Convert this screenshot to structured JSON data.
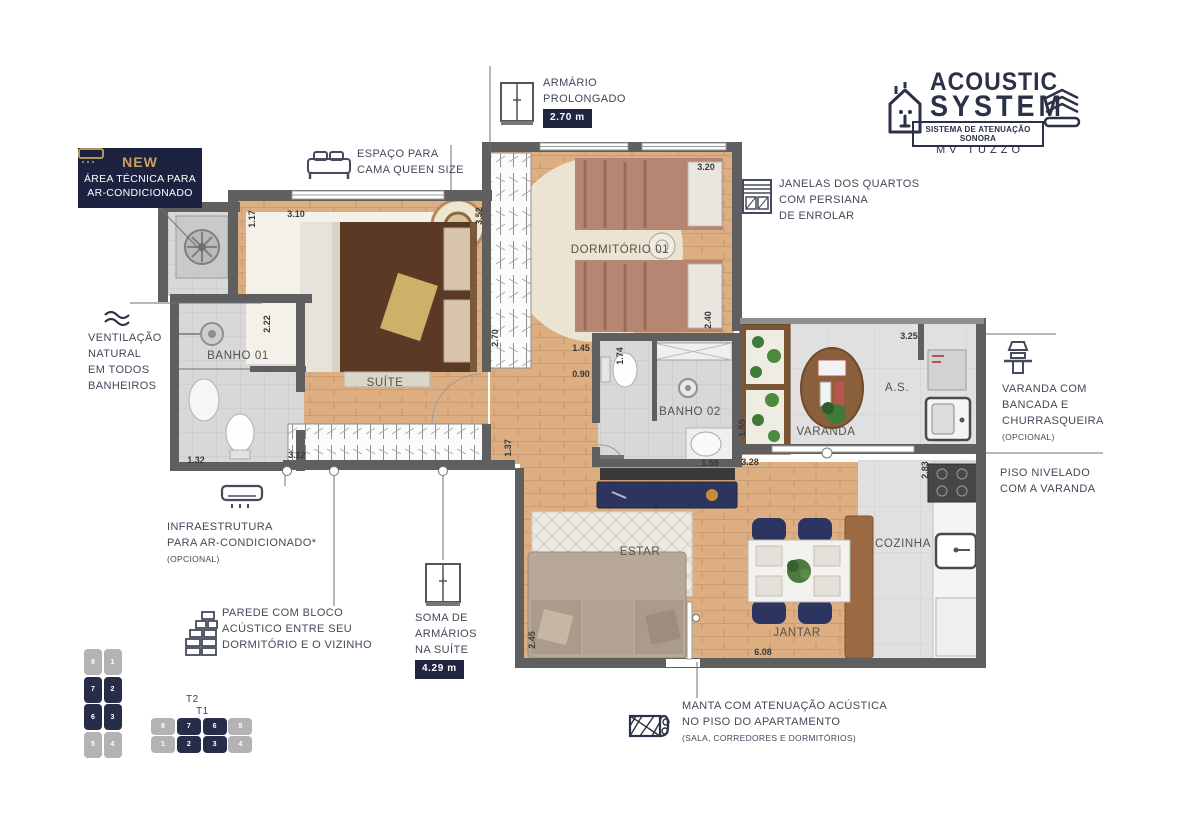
{
  "logo": {
    "title_line1": "ACOUSTIC",
    "title_line2": "SYSTEM",
    "subtitle": "SISTEMA DE ATENUAÇÃO SONORA",
    "brand": "MV TUZZO"
  },
  "badges": {
    "new_tag": "NEW",
    "area_tecnica": [
      "ÁREA TÉCNICA PARA",
      "AR-CONDICIONADO"
    ],
    "armario_prolongado": {
      "lines": [
        "ARMÁRIO",
        "PROLONGADO"
      ],
      "value": "2.70 m"
    },
    "soma_armarios": {
      "lines": [
        "SOMA DE",
        "ARMÁRIOS",
        "NA SUÍTE"
      ],
      "value": "4.29 m"
    }
  },
  "annotations": {
    "espaco_cama": [
      "ESPAÇO PARA",
      "CAMA QUEEN SIZE"
    ],
    "janelas": [
      "JANELAS DOS QUARTOS",
      "COM PERSIANA",
      "DE ENROLAR"
    ],
    "ventilacao": [
      "VENTILAÇÃO",
      "NATURAL",
      "EM TODOS",
      "BANHEIROS"
    ],
    "varanda_churrasqueira": [
      "VARANDA COM",
      "BANCADA E",
      "CHURRASQUEIRA"
    ],
    "varanda_churrasqueira_note": "(OPCIONAL)",
    "piso_nivelado": [
      "PISO NIVELADO",
      "COM A VARANDA"
    ],
    "infraestrutura": [
      "INFRAESTRUTURA",
      "PARA AR-CONDICIONADO*"
    ],
    "infraestrutura_note": "(OPCIONAL)",
    "parede_acustica": [
      "PAREDE COM BLOCO",
      "ACÚSTICO ENTRE SEU",
      "DORMITÓRIO E O VIZINHO"
    ],
    "manta": [
      "MANTA COM ATENUAÇÃO ACÚSTICA",
      "NO PISO DO APARTAMENTO"
    ],
    "manta_note": "(SALA, CORREDORES E DORMITÓRIOS)"
  },
  "plan": {
    "rooms": [
      {
        "label": "SUÍTE",
        "x": 385,
        "y": 383
      },
      {
        "label": "BANHO 01",
        "x": 238,
        "y": 356
      },
      {
        "label": "DORMITÓRIO 01",
        "x": 620,
        "y": 250
      },
      {
        "label": "BANHO 02",
        "x": 690,
        "y": 412
      },
      {
        "label": "VARANDA",
        "x": 826,
        "y": 432
      },
      {
        "label": "A.S.",
        "x": 897,
        "y": 388
      },
      {
        "label": "COZINHA",
        "x": 903,
        "y": 544
      },
      {
        "label": "ESTAR",
        "x": 640,
        "y": 552
      },
      {
        "label": "JANTAR",
        "x": 797,
        "y": 633
      }
    ],
    "dimensions": [
      {
        "value": "1.17",
        "x": 252,
        "y": 219,
        "rot": true
      },
      {
        "value": "3.10",
        "x": 296,
        "y": 214,
        "rot": false
      },
      {
        "value": "3.52",
        "x": 479,
        "y": 216,
        "rot": true
      },
      {
        "value": "2.70",
        "x": 495,
        "y": 338,
        "rot": true
      },
      {
        "value": "3.20",
        "x": 706,
        "y": 167,
        "rot": false
      },
      {
        "value": "2.40",
        "x": 708,
        "y": 320,
        "rot": true
      },
      {
        "value": "1.45",
        "x": 581,
        "y": 348,
        "rot": false
      },
      {
        "value": "0.90",
        "x": 581,
        "y": 374,
        "rot": false
      },
      {
        "value": "1.74",
        "x": 620,
        "y": 356,
        "rot": true
      },
      {
        "value": "1.59",
        "x": 710,
        "y": 463,
        "rot": false
      },
      {
        "value": "1.55",
        "x": 742,
        "y": 428,
        "rot": true
      },
      {
        "value": "3.28",
        "x": 750,
        "y": 462,
        "rot": false
      },
      {
        "value": "3.25",
        "x": 909,
        "y": 336,
        "rot": false
      },
      {
        "value": "2.83",
        "x": 925,
        "y": 470,
        "rot": true
      },
      {
        "value": "2.22",
        "x": 267,
        "y": 324,
        "rot": true
      },
      {
        "value": "1.32",
        "x": 196,
        "y": 460,
        "rot": false
      },
      {
        "value": "3.12",
        "x": 297,
        "y": 455,
        "rot": false
      },
      {
        "value": "1.37",
        "x": 508,
        "y": 448,
        "rot": true
      },
      {
        "value": "2.45",
        "x": 532,
        "y": 640,
        "rot": true
      },
      {
        "value": "6.08",
        "x": 763,
        "y": 652,
        "rot": false
      }
    ]
  },
  "keyplan": {
    "t2": {
      "label": "T2",
      "rows": [
        [
          "8",
          "1"
        ],
        [
          "7",
          "2"
        ],
        [
          "6",
          "3"
        ],
        [
          "5",
          "4"
        ]
      ],
      "active": [
        "7",
        "2",
        "6",
        "3"
      ]
    },
    "t1": {
      "label": "T1",
      "cols": [
        [
          "8",
          "1"
        ],
        [
          "7",
          "2"
        ],
        [
          "6",
          "3"
        ],
        [
          "5",
          "4"
        ]
      ],
      "active": [
        "7",
        "2",
        "6",
        "3"
      ]
    }
  },
  "colors": {
    "navy": "#20263f",
    "gold": "#c9a15a",
    "wall": "#5f5f5f",
    "wood": "#dcae82",
    "tile": "#d7d7d7",
    "unit_active": "#272c49",
    "unit_muted": "#b3b3b6"
  }
}
